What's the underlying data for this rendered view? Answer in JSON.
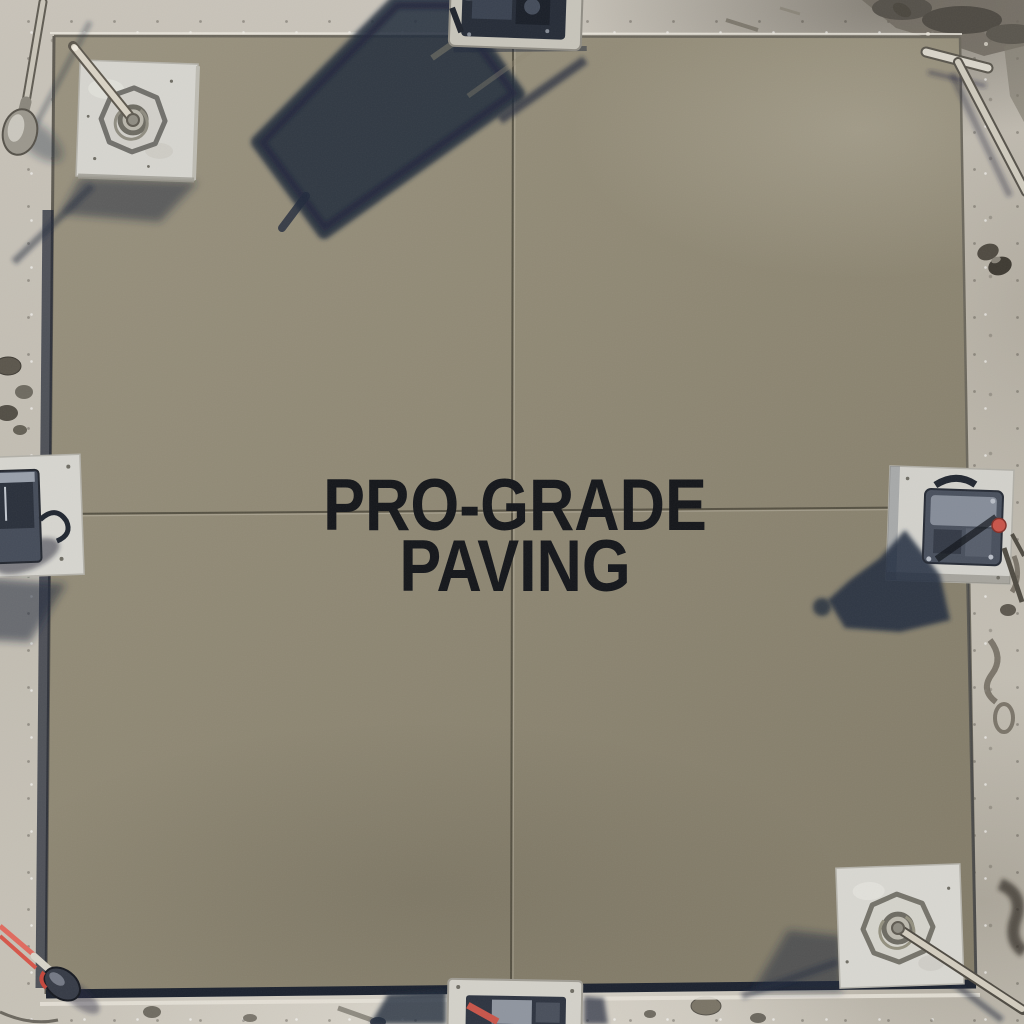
{
  "scene": {
    "headline": {
      "line1": "PRO-GRADE",
      "line2": "PAVING"
    },
    "colors": {
      "slab": "#908975",
      "ground": "#c4bfb5",
      "shadow": "#222a3c",
      "headline_text": "#14161a",
      "pad_concrete": "#d6d5cf",
      "machine_dark": "#2a303c",
      "accent_red": "#c8554a"
    }
  }
}
